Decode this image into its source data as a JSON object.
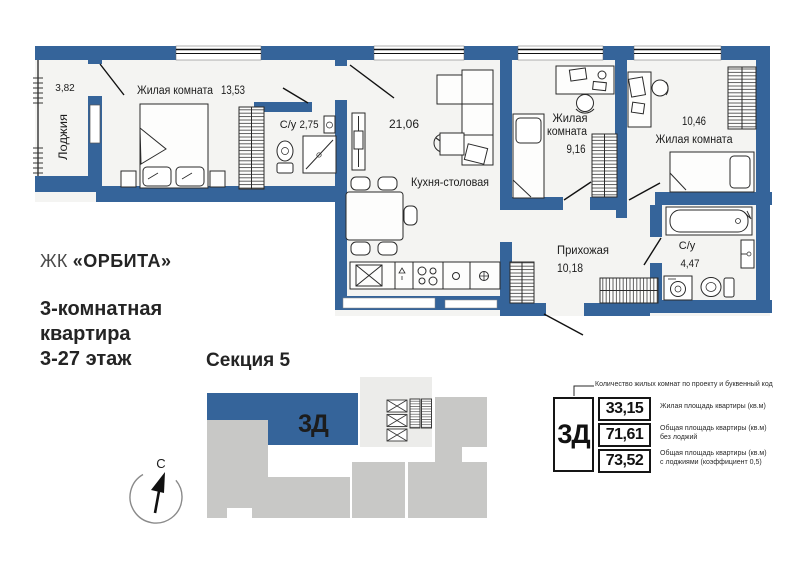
{
  "header": {
    "project_prefix": "ЖК",
    "project_name": "«ОРБИТА»",
    "apartment_line1": "3-комнатная",
    "apartment_line2": "квартира",
    "apartment_line3": "3-27 этаж"
  },
  "plan": {
    "loggia_label": "Лоджия",
    "loggia_area": "3,82",
    "room1_label": "Жилая комната",
    "room1_area": "13,53",
    "bath1_label": "С/у",
    "bath1_area": "2,75",
    "kitchen_area": "21,06",
    "kitchen_label": "Кухня-столовая",
    "room2_label_line1": "Жилая",
    "room2_label_line2": "комната",
    "room2_area": "9,16",
    "room3_area": "10,46",
    "room3_label": "Жилая комната",
    "hall_label": "Прихожая",
    "hall_area": "10,18",
    "bath2_label": "С/у",
    "bath2_area": "4,47"
  },
  "section": {
    "title": "Секция 5",
    "unit_code": "3Д"
  },
  "compass": {
    "north": "С"
  },
  "legend": {
    "annotation": "Количество жилых комнат по проекту и буквенный код",
    "unit_code": "3Д",
    "rows": [
      {
        "value": "33,15",
        "desc1": "Жилая площадь квартиры (кв.м)",
        "desc2": ""
      },
      {
        "value": "71,61",
        "desc1": "Общая площадь квартиры (кв.м)",
        "desc2": "без лоджий"
      },
      {
        "value": "73,52",
        "desc1": "Общая площадь квартиры (кв.м)",
        "desc2": "с лоджиями (коэффициент 0,5)"
      }
    ]
  },
  "colors": {
    "wall_blue": "#35649a",
    "unit_blue": "#35649a",
    "block_gray": "#c8c8c6",
    "core_gray": "#ececea",
    "room_fill": "#f4f4f2"
  }
}
